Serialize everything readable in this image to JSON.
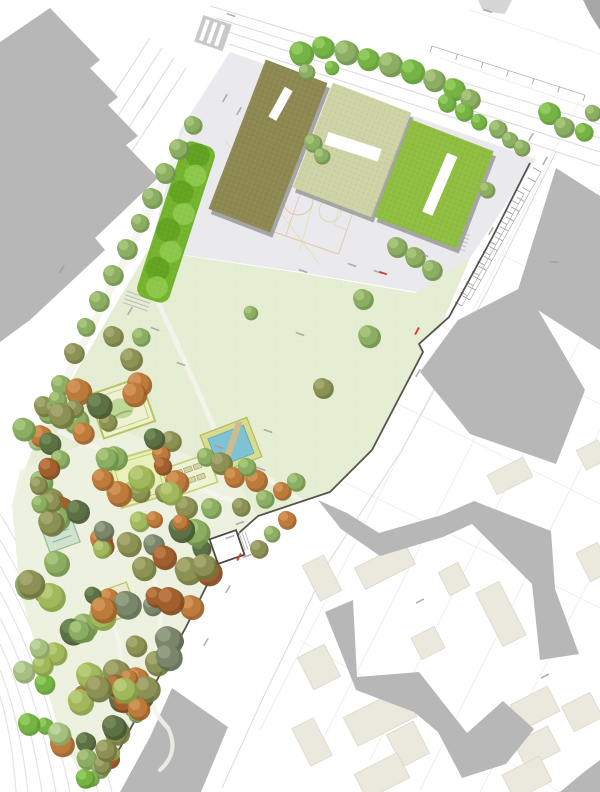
{
  "plan": {
    "kind": "landscape-masterplan",
    "park_elements": {
      "water_basin": "pool-with-bridge",
      "hedge_band": "linear-grove",
      "garden_rooms": [
        "playground-garden",
        "lawn-garden",
        "community-beds",
        "flower-garden",
        "teal-garden"
      ],
      "pavilion": "park-entrance-kiosk"
    }
  },
  "colors": {
    "background": "#ffffff",
    "street_line": "#dadada",
    "parcel_line": "#ececea",
    "railway_line": "#e4e4e2",
    "lane_dash": "#d6d6d6",
    "building_gray": "#b7b7b7",
    "building_gray_dark": "#a6a6a6",
    "building_gray_light": "#cccccc",
    "block_beige": "#eae8dc",
    "block_beige_edge": "#d9d6c6",
    "plaza": "#e9e9ed",
    "lawn": "#e5edd3",
    "forest_floor": "#eff1e0",
    "promenade": "#f4f4ec",
    "path_light": "#f5f5ee",
    "roof_olive": "#8e8952",
    "roof_sage": "#cdd3a4",
    "roof_green": "#8fbe41",
    "roof_shadow": "#9d9d9d",
    "skylight": "#ffffff",
    "hedge": "#74b42e",
    "hedge_dark": "#5c9d1e",
    "hedge_light": "#94cd52",
    "pool_deck": "#d9dc8e",
    "pool_deck_edge": "#b5ba60",
    "pool_water": "#7fc3d2",
    "pool_water_edge": "#58a7b8",
    "pool_bridge": "#ccbc90",
    "enclosure_fill": "#eef2d3",
    "enclosure_border": "#b9c45e",
    "enclosure_border2": "#c6cf74",
    "enclosure_lawn": "#e9efb8",
    "play_blob": "#b7d490",
    "garden_teal": "#cfe3cf",
    "garden_teal_edge": "#9cb98f",
    "bed_fill": "#d2d3a2",
    "bed_edge": "#8f9361",
    "flower_pink": "#d98fb2",
    "flower_purple": "#b48fc9",
    "wall": "#54544c",
    "court_orange": "#dfb070",
    "court_green": "#c9d48a",
    "court_yellow": "#d8d98c",
    "accent_red": "#e03428",
    "annotation": "#9c9c9c",
    "steps": "#bdbdbd",
    "pavilion": "#ffffff",
    "pavilion_edge": "#4a4a44",
    "crosswalk": "#c9c9c9"
  },
  "tree_palette": [
    {
      "b": "#76b445",
      "d": "#5d9c31",
      "l": "#97cf63"
    },
    {
      "b": "#8caf63",
      "d": "#6f934a",
      "l": "#abc87f"
    },
    {
      "b": "#a8c183",
      "d": "#8ba768",
      "l": "#c3d7a2"
    },
    {
      "b": "#8d9155",
      "d": "#71763c",
      "l": "#a9ad73"
    },
    {
      "b": "#6e7a43",
      "d": "#565f2f",
      "l": "#8b9a5e"
    },
    {
      "b": "#bf7c3c",
      "d": "#9e5f27",
      "l": "#d69a5d"
    },
    {
      "b": "#a2602e",
      "d": "#82481d",
      "l": "#c07f4a"
    },
    {
      "b": "#5c7245",
      "d": "#46572f",
      "l": "#768e5d"
    },
    {
      "b": "#7b876b",
      "d": "#616d52",
      "l": "#99a589"
    },
    {
      "b": "#a2b85e",
      "d": "#86a043",
      "l": "#bdd07e"
    }
  ],
  "trees": {
    "placed": [
      [
        300,
        52,
        12,
        0
      ],
      [
        322,
        46,
        11,
        0
      ],
      [
        345,
        51,
        12,
        1
      ],
      [
        367,
        58,
        11,
        0
      ],
      [
        389,
        63,
        12,
        1
      ],
      [
        411,
        70,
        12,
        0
      ],
      [
        433,
        79,
        11,
        1
      ],
      [
        453,
        88,
        11,
        0
      ],
      [
        469,
        98,
        10,
        1
      ],
      [
        306,
        71,
        8,
        1
      ],
      [
        331,
        67,
        7,
        0
      ],
      [
        548,
        112,
        11,
        0
      ],
      [
        563,
        126,
        10,
        1
      ],
      [
        583,
        131,
        9,
        0
      ],
      [
        592,
        112,
        8,
        1
      ],
      [
        312,
        142,
        9,
        1
      ],
      [
        321,
        155,
        8,
        1
      ],
      [
        396,
        246,
        10,
        1
      ],
      [
        414,
        256,
        10,
        1
      ],
      [
        431,
        269,
        10,
        1
      ],
      [
        486,
        189,
        8,
        1
      ],
      [
        497,
        128,
        9,
        1
      ],
      [
        509,
        139,
        8,
        1
      ],
      [
        446,
        102,
        9,
        0
      ],
      [
        463,
        111,
        9,
        0
      ],
      [
        478,
        121,
        8,
        0
      ],
      [
        521,
        147,
        8,
        1
      ],
      [
        192,
        124,
        9,
        1
      ],
      [
        178,
        148,
        10,
        1
      ],
      [
        164,
        172,
        10,
        1
      ],
      [
        151,
        197,
        10,
        1
      ],
      [
        139,
        222,
        9,
        1
      ],
      [
        126,
        248,
        10,
        1
      ],
      [
        112,
        274,
        10,
        1
      ],
      [
        98,
        300,
        10,
        1
      ],
      [
        85,
        326,
        9,
        1
      ],
      [
        73,
        352,
        10,
        3
      ],
      [
        60,
        384,
        10,
        1
      ],
      [
        47,
        412,
        10,
        1
      ],
      [
        36,
        440,
        9,
        2
      ],
      [
        77,
        390,
        13,
        5
      ],
      [
        112,
        335,
        10,
        3
      ],
      [
        140,
        336,
        9,
        1
      ],
      [
        130,
        358,
        11,
        3
      ],
      [
        138,
        383,
        12,
        5
      ],
      [
        362,
        298,
        10,
        1
      ],
      [
        368,
        335,
        11,
        1
      ],
      [
        322,
        387,
        10,
        3
      ],
      [
        250,
        312,
        7,
        1
      ],
      [
        170,
        440,
        10,
        3
      ],
      [
        160,
        453,
        9,
        5
      ],
      [
        205,
        456,
        9,
        1
      ],
      [
        220,
        462,
        11,
        3
      ],
      [
        233,
        476,
        10,
        5
      ],
      [
        255,
        479,
        11,
        5
      ],
      [
        246,
        466,
        9,
        1
      ],
      [
        185,
        506,
        11,
        3
      ],
      [
        210,
        507,
        10,
        1
      ],
      [
        240,
        506,
        9,
        3
      ],
      [
        264,
        498,
        9,
        1
      ],
      [
        281,
        490,
        9,
        5
      ],
      [
        295,
        481,
        9,
        1
      ],
      [
        133,
        393,
        12,
        5
      ],
      [
        107,
        421,
        9,
        3
      ],
      [
        130,
        489,
        8,
        9
      ],
      [
        163,
        492,
        9,
        3
      ],
      [
        258,
        548,
        9,
        3
      ],
      [
        271,
        533,
        8,
        1
      ],
      [
        286,
        519,
        9,
        5
      ]
    ],
    "clusters": [
      {
        "cx": 62,
        "cy": 423,
        "rx": 52,
        "ry": 34,
        "rot": -20,
        "count": 12,
        "rmin": 8,
        "rmax": 13,
        "seed": 7,
        "palette": [
          1,
          3,
          5,
          3,
          1,
          7
        ]
      },
      {
        "cx": 115,
        "cy": 482,
        "rx": 92,
        "ry": 44,
        "rot": -16,
        "count": 20,
        "rmin": 8,
        "rmax": 14,
        "seed": 11,
        "palette": [
          3,
          1,
          5,
          6,
          1,
          3,
          7,
          9
        ]
      },
      {
        "cx": 120,
        "cy": 565,
        "rx": 98,
        "ry": 52,
        "rot": -14,
        "count": 26,
        "rmin": 8,
        "rmax": 14,
        "seed": 23,
        "palette": [
          3,
          5,
          1,
          7,
          6,
          3,
          9,
          8
        ]
      },
      {
        "cx": 133,
        "cy": 650,
        "rx": 85,
        "ry": 52,
        "rot": -22,
        "count": 24,
        "rmin": 8,
        "rmax": 14,
        "seed": 31,
        "palette": [
          1,
          3,
          5,
          7,
          6,
          9,
          3,
          8
        ]
      },
      {
        "cx": 110,
        "cy": 722,
        "rx": 62,
        "ry": 42,
        "rot": -26,
        "count": 16,
        "rmin": 8,
        "rmax": 13,
        "seed": 43,
        "palette": [
          3,
          1,
          6,
          5,
          7,
          9
        ]
      },
      {
        "cx": 92,
        "cy": 768,
        "rx": 38,
        "ry": 18,
        "rot": -28,
        "count": 7,
        "rmin": 7,
        "rmax": 11,
        "seed": 51,
        "palette": [
          1,
          3,
          0,
          9
        ]
      },
      {
        "cx": 45,
        "cy": 700,
        "rx": 30,
        "ry": 60,
        "rot": -10,
        "count": 8,
        "rmin": 7,
        "rmax": 12,
        "seed": 60,
        "palette": [
          0,
          2,
          9
        ]
      }
    ]
  },
  "city_blocks": [
    [
      494,
      324,
      34,
      26,
      -27
    ],
    [
      510,
      476,
      40,
      22,
      -27
    ],
    [
      592,
      455,
      24,
      22,
      -27
    ],
    [
      594,
      562,
      24,
      32,
      -27
    ],
    [
      322,
      578,
      24,
      40,
      -27
    ],
    [
      385,
      566,
      56,
      24,
      -27
    ],
    [
      454,
      579,
      22,
      26,
      -27
    ],
    [
      501,
      614,
      26,
      60,
      -27
    ],
    [
      428,
      643,
      26,
      24,
      -27
    ],
    [
      319,
      667,
      30,
      36,
      -27
    ],
    [
      380,
      717,
      66,
      32,
      -27
    ],
    [
      408,
      744,
      30,
      36,
      -27
    ],
    [
      382,
      776,
      48,
      28,
      -27
    ],
    [
      312,
      742,
      24,
      42,
      -27
    ],
    [
      535,
      708,
      42,
      28,
      -27
    ],
    [
      582,
      712,
      32,
      28,
      -27
    ],
    [
      537,
      747,
      38,
      28,
      -27
    ],
    [
      527,
      778,
      42,
      28,
      -27
    ]
  ],
  "linework": {
    "street_lines": [
      [
        210,
        6,
        600,
        124
      ],
      [
        216,
        18,
        600,
        138
      ],
      [
        222,
        30,
        600,
        152
      ],
      [
        229,
        44,
        600,
        166
      ],
      [
        150,
        38,
        20,
        238
      ],
      [
        162,
        48,
        32,
        248
      ],
      [
        174,
        58,
        44,
        258
      ],
      [
        186,
        68,
        56,
        268
      ]
    ],
    "edge_polylines": [
      "556,152 488,290 402,450 330,560 262,700 222,788"
    ],
    "parcel_lines": [
      [
        580,
        100,
        260,
        730
      ],
      [
        600,
        190,
        320,
        745
      ],
      [
        600,
        300,
        370,
        760
      ],
      [
        600,
        430,
        420,
        790
      ],
      [
        600,
        560,
        480,
        792
      ],
      [
        340,
        480,
        600,
        608
      ],
      [
        390,
        400,
        600,
        504
      ],
      [
        430,
        320,
        600,
        404
      ],
      [
        470,
        240,
        600,
        302
      ],
      [
        300,
        640,
        560,
        792
      ],
      [
        470,
        10,
        600,
        54
      ],
      [
        440,
        58,
        600,
        112
      ]
    ],
    "railway_curves": [
      "M0,514 Q68,624 112,792",
      "M0,540 Q60,640 98,792",
      "M0,566 Q52,656 84,792",
      "M0,592 Q44,672 70,792",
      "M0,618 Q36,688 56,792",
      "M0,644 Q28,704 42,792",
      "M0,670 Q20,720 28,792",
      "M0,696 Q12,736 16,792"
    ],
    "lane_dashes": [
      [
        150,
        95,
        142,
        108
      ],
      [
        130,
        128,
        122,
        141
      ],
      [
        110,
        161,
        102,
        174
      ],
      [
        96,
        190,
        88,
        203
      ]
    ]
  },
  "parking": {
    "rows": [
      {
        "x1": 541,
        "y1": 172,
        "x2": 470,
        "y2": 300,
        "n": 14,
        "len": 9
      },
      {
        "x1": 524,
        "y1": 194,
        "x2": 462,
        "y2": 306,
        "n": 12,
        "len": 8
      },
      {
        "x1": 432,
        "y1": 46,
        "x2": 585,
        "y2": 95,
        "n": 7,
        "len": 6
      }
    ]
  },
  "annotations": {
    "marks": [
      [
        231,
        15,
        19
      ],
      [
        488,
        11,
        19
      ],
      [
        225,
        98,
        -60
      ],
      [
        239,
        111,
        -60
      ],
      [
        531,
        137,
        -60
      ],
      [
        545,
        161,
        -60
      ],
      [
        491,
        231,
        -60
      ],
      [
        554,
        262,
        0
      ],
      [
        378,
        272,
        19
      ],
      [
        303,
        271,
        19
      ],
      [
        352,
        265,
        19
      ],
      [
        424,
        255,
        19
      ],
      [
        300,
        334,
        19
      ],
      [
        155,
        329,
        19
      ],
      [
        181,
        364,
        19
      ],
      [
        130,
        311,
        -60
      ],
      [
        62,
        269,
        -60
      ],
      [
        418,
        373,
        -60
      ],
      [
        268,
        431,
        19
      ],
      [
        219,
        447,
        19
      ],
      [
        261,
        469,
        19
      ],
      [
        240,
        523,
        -20
      ],
      [
        230,
        537,
        -20
      ],
      [
        247,
        556,
        -20
      ],
      [
        420,
        601,
        -27
      ],
      [
        545,
        676,
        -27
      ],
      [
        228,
        589,
        -60
      ],
      [
        206,
        642,
        -60
      ]
    ],
    "red_marks": [
      [
        383,
        273,
        19
      ],
      [
        417,
        331,
        -62
      ],
      [
        239,
        557,
        -62
      ]
    ]
  }
}
